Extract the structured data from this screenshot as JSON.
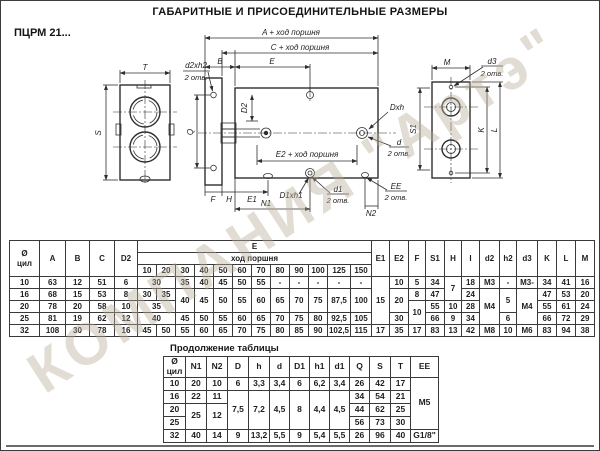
{
  "page": {
    "title": "ГАБАРИТНЫЕ И ПРИСОЕДИНИТЕЛЬНЫЕ РАЗМЕРЫ",
    "model": "ПЦРМ 21...",
    "continuation_label": "Продолжение таблицы",
    "watermark": "КОМПАНИЯ \"Артэ\"",
    "line_color": "#2f2f2f",
    "watermark_color": "#b8ab98"
  },
  "drawing": {
    "labels": {
      "a_stroke": "A + ход поршня",
      "c_stroke": "C + ход поршня",
      "e2_stroke": "E2 + ход поршня",
      "b": "B",
      "e": "E",
      "t": "T",
      "s": "S",
      "q": "Q",
      "d2_dim": "D2",
      "d2xh2": "d2xh2",
      "two_holes": "2 отв.",
      "dxh": "Dxh",
      "d": "d",
      "f": "F",
      "h": "H",
      "e1": "E1",
      "n1": "N1",
      "d1xh1": "D1xh1",
      "d1": "d1",
      "n2": "N2",
      "ee": "EE",
      "m": "M",
      "d3": "d3",
      "s1": "S1",
      "k": "K",
      "l": "L"
    }
  },
  "table1": {
    "header_rows": [
      [
        {
          "t": "Ø\nцил",
          "rs": 3
        },
        {
          "t": "A",
          "rs": 3
        },
        {
          "t": "B",
          "rs": 3
        },
        {
          "t": "C",
          "rs": 3
        },
        {
          "t": "D2",
          "rs": 3
        },
        {
          "t": "E",
          "cs": 12
        },
        {
          "t": "E1",
          "rs": 3
        },
        {
          "t": "E2",
          "rs": 3
        },
        {
          "t": "F",
          "rs": 3
        },
        {
          "t": "S1",
          "rs": 3
        },
        {
          "t": "H",
          "rs": 3
        },
        {
          "t": "I",
          "rs": 3
        },
        {
          "t": "d2",
          "rs": 3
        },
        {
          "t": "h2",
          "rs": 3
        },
        {
          "t": "d3",
          "rs": 3
        },
        {
          "t": "K",
          "rs": 3
        },
        {
          "t": "L",
          "rs": 3
        },
        {
          "t": "M",
          "rs": 3
        }
      ],
      [
        {
          "t": "ход поршня",
          "cs": 12
        }
      ],
      [
        "10",
        "20",
        "30",
        "40",
        "50",
        "60",
        "70",
        "80",
        "90",
        "100",
        "125",
        "150"
      ]
    ],
    "rows": [
      [
        "10",
        "63",
        "12",
        "51",
        "6",
        {
          "t": "30",
          "cs": 2
        },
        "35",
        "40",
        "45",
        "50",
        "55",
        "-",
        "-",
        "-",
        "-",
        "-",
        {
          "t": "15",
          "rs": 4
        },
        "10",
        "5",
        "34",
        {
          "t": "7",
          "rs": 2
        },
        "18",
        "M3",
        "-",
        "M3-",
        "34",
        "41",
        "16"
      ],
      [
        "16",
        "68",
        "15",
        "53",
        "8",
        "30",
        "35",
        {
          "t": "40",
          "rs": 2
        },
        {
          "t": "45",
          "rs": 2
        },
        {
          "t": "50",
          "rs": 2
        },
        {
          "t": "55",
          "rs": 2
        },
        {
          "t": "60",
          "rs": 2
        },
        {
          "t": "65",
          "rs": 2
        },
        {
          "t": "70",
          "rs": 2
        },
        {
          "t": "75",
          "rs": 2
        },
        {
          "t": "87,5",
          "rs": 2
        },
        {
          "t": "100",
          "rs": 2
        },
        {
          "t": "20",
          "rs": 2
        },
        "8",
        "47",
        "24",
        {
          "t": "M4",
          "rs": 3
        },
        {
          "t": "5",
          "rs": 2
        },
        {
          "t": "M4",
          "rs": 3
        },
        "47",
        "53",
        "20"
      ],
      [
        "20",
        "78",
        "20",
        "58",
        "10",
        {
          "t": "35",
          "cs": 2
        },
        {
          "t": "10",
          "rs": 2
        },
        "55",
        "10",
        "28",
        "55",
        "61",
        "24"
      ],
      [
        "25",
        "81",
        "19",
        "62",
        "12",
        {
          "t": "40",
          "cs": 2
        },
        "45",
        "50",
        "55",
        "60",
        "65",
        "70",
        "75",
        "80",
        "92,5",
        "105",
        "30",
        "66",
        "9",
        "34",
        "6",
        "66",
        "72",
        "29"
      ],
      [
        "32",
        "108",
        "30",
        "78",
        "16",
        "45",
        "50",
        "55",
        "60",
        "65",
        "70",
        "75",
        "80",
        "85",
        "90",
        "102,5",
        "115",
        "17",
        "35",
        "17",
        "83",
        "13",
        "42",
        "M8",
        "10",
        "M6",
        "83",
        "94",
        "38"
      ]
    ]
  },
  "table2": {
    "header_rows": [
      [
        "Ø\nцил",
        "N1",
        "N2",
        "D",
        "h",
        "d",
        "D1",
        "h1",
        "d1",
        "Q",
        "S",
        "T",
        "EE"
      ]
    ],
    "rows": [
      [
        "10",
        "20",
        "10",
        "6",
        "3,3",
        "3,4",
        "6",
        "6,2",
        "3,4",
        "26",
        "42",
        "17",
        {
          "t": "M5",
          "rs": 4
        }
      ],
      [
        "16",
        "22",
        "11",
        {
          "t": "7,5",
          "rs": 3
        },
        {
          "t": "7,2",
          "rs": 3
        },
        {
          "t": "4,5",
          "rs": 3
        },
        {
          "t": "8",
          "rs": 3
        },
        {
          "t": "4,4",
          "rs": 3
        },
        {
          "t": "4,5",
          "rs": 3
        },
        "34",
        "54",
        "21"
      ],
      [
        "20",
        {
          "t": "25",
          "rs": 2
        },
        {
          "t": "12",
          "rs": 2
        },
        "44",
        "62",
        "25"
      ],
      [
        "25",
        "56",
        "73",
        "30"
      ],
      [
        "32",
        "40",
        "14",
        "9",
        "13,2",
        "5,5",
        "9",
        "5,4",
        "5,5",
        "26",
        "96",
        "40",
        "G1/8\""
      ]
    ]
  }
}
